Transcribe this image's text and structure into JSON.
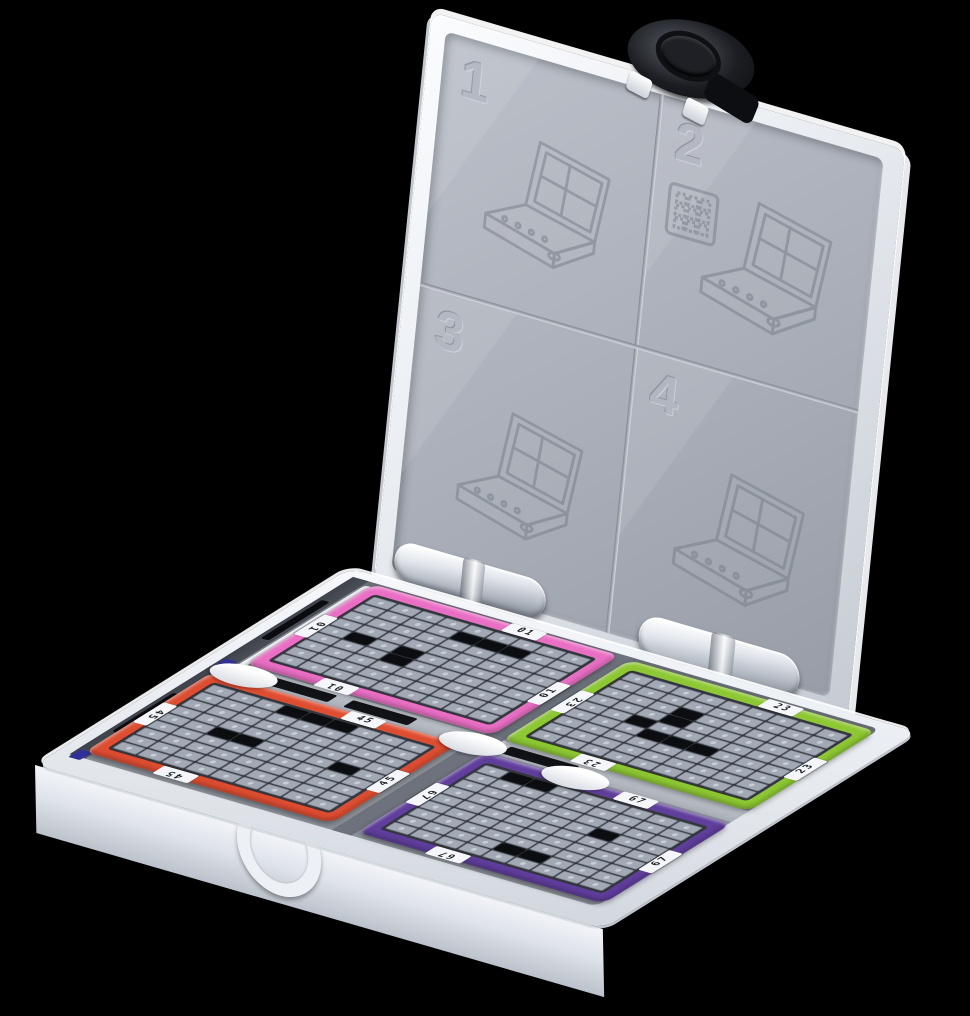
{
  "scene": {
    "background": "#000000"
  },
  "palette": {
    "case-white": "#eef1f6",
    "case-shade": "#c6cbd3",
    "panel-gray": "#a9aeb8",
    "panel-gray-dark": "#989da7",
    "well-gray": "#8b9099",
    "wall-dark": "#4b4f58",
    "slot-black": "#0c0d10",
    "latch-black": "#17181b",
    "chip-gray": "#a2a9b4",
    "chip-edge": "#747b87",
    "chip-dot": "#c7cdd5",
    "mat-dark": "#33363c",
    "tab-white": "#f4f6f9",
    "tab-text": "#1b1d21",
    "blue-clip": "#30309a"
  },
  "lid": {
    "panels": [
      {
        "number": "1"
      },
      {
        "number": "2"
      },
      {
        "number": "3"
      },
      {
        "number": "4"
      }
    ]
  },
  "hinges": {
    "count": 2
  },
  "icons": {
    "latch-icon": "black oval cam latch with round center disc",
    "hinge-icon": "white cylindrical barrel hinge",
    "clasp-icon": "white D-ring pull on front face",
    "case-diagram-icon": "embossed line drawing of the open case",
    "sheet-icon": "embossed chip-sheet square with dotted grid",
    "thumb-scoop": "white semicircular finger scoop"
  },
  "base": {
    "grid": {
      "rows": 9,
      "cols": 9
    },
    "trays": [
      {
        "position": "back-left",
        "label": "01",
        "color": "#ea6fc4",
        "missing": [
          [
            1,
            4
          ],
          [
            1,
            5
          ],
          [
            1,
            6
          ],
          [
            4,
            1
          ],
          [
            4,
            3
          ],
          [
            5,
            3
          ]
        ]
      },
      {
        "position": "back-right",
        "label": "23",
        "color": "#8dc832",
        "missing": [
          [
            2,
            3
          ],
          [
            3,
            3
          ],
          [
            4,
            2
          ],
          [
            5,
            3
          ],
          [
            5,
            4
          ],
          [
            5,
            5
          ]
        ]
      },
      {
        "position": "front-left",
        "label": "45",
        "color": "#df4d31",
        "missing": [
          [
            0,
            3
          ],
          [
            0,
            4
          ],
          [
            0,
            5
          ],
          [
            4,
            2
          ],
          [
            4,
            3
          ],
          [
            4,
            7
          ]
        ]
      },
      {
        "position": "front-right",
        "label": "67",
        "color": "#5f3e9c",
        "missing": [
          [
            0,
            1
          ],
          [
            0,
            2
          ],
          [
            3,
            6
          ],
          [
            7,
            4
          ],
          [
            7,
            5
          ]
        ]
      }
    ]
  }
}
